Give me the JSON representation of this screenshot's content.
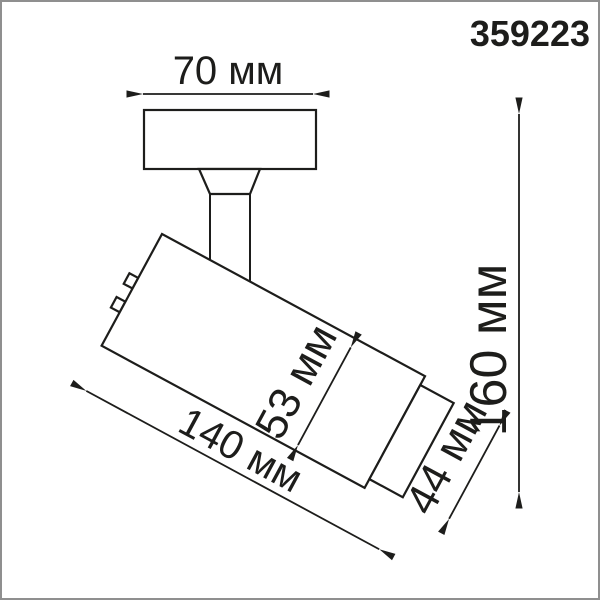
{
  "product": {
    "code": "359223"
  },
  "dimensions": {
    "base_width": {
      "label": "70 мм",
      "value_mm": 70
    },
    "total_height": {
      "label": "160 мм",
      "value_mm": 160
    },
    "body_diameter": {
      "label": "53 мм",
      "value_mm": 53
    },
    "body_length": {
      "label": "140 мм",
      "value_mm": 140
    },
    "head_diameter": {
      "label": "44 мм",
      "value_mm": 44
    }
  },
  "style": {
    "line_color": "#1d1d1b",
    "background": "#ffffff",
    "frame_border": "#8f8f8f"
  }
}
